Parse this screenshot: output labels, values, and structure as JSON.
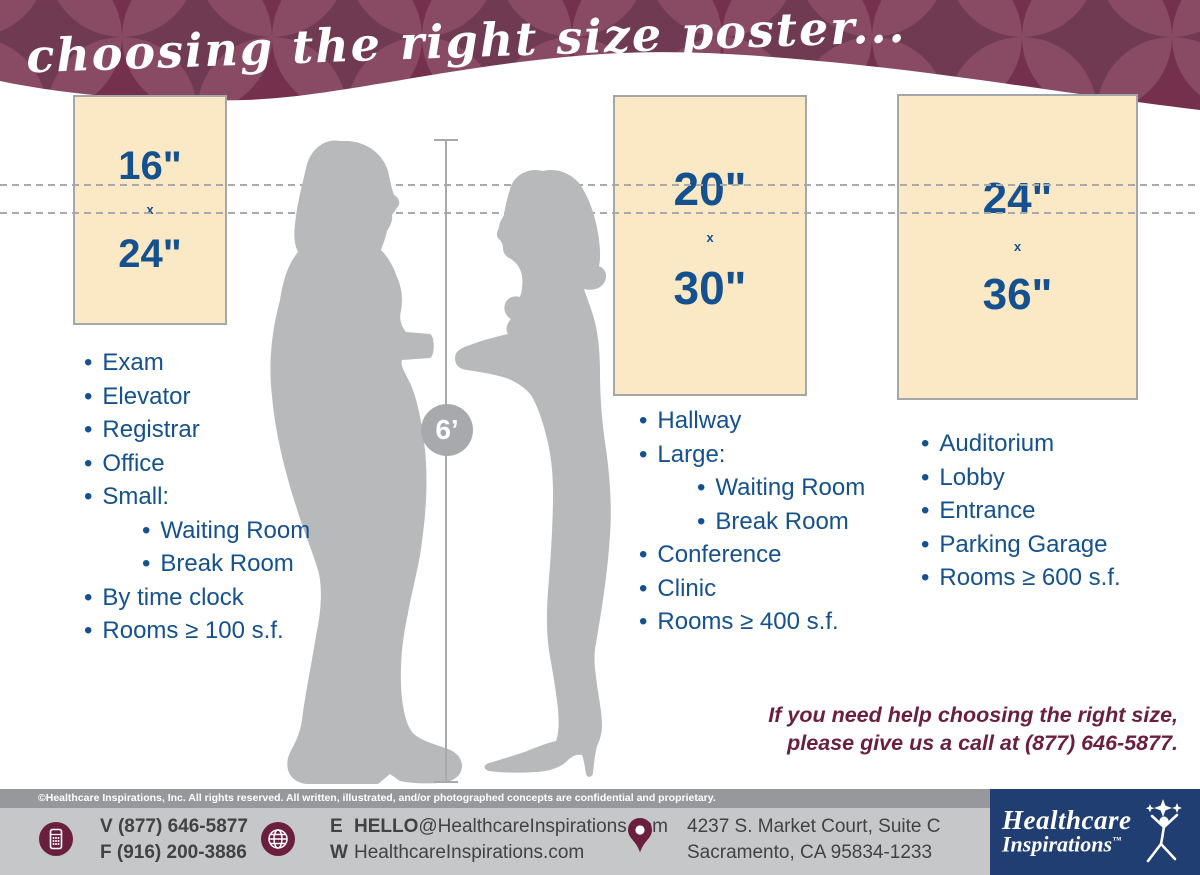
{
  "colors": {
    "maroon": "#6b1f3e",
    "navy": "#203e72",
    "blue": "#14518e",
    "cream": "#fbe8c4",
    "creamBorder": "#a3a7ab",
    "silhouette": "#b7b9bb",
    "grayLine": "#a7a9ac",
    "dashGray": "#a8aaac",
    "stripGray": "#97989b",
    "barGray": "#c6c7c9",
    "textDark": "#414244",
    "patternDark": "#3c0e29",
    "patternMid": "#74304c",
    "patternLight": "#9b5e76"
  },
  "header": {
    "title": "choosing the right size poster..."
  },
  "ui": {
    "bullet": "•"
  },
  "measure": {
    "label": "6’"
  },
  "posters": [
    {
      "size_top": "16\"",
      "size_mid": "x",
      "size_bottom": "24\"",
      "locations": [
        {
          "text": "Exam"
        },
        {
          "text": "Elevator"
        },
        {
          "text": "Registrar"
        },
        {
          "text": "Office"
        },
        {
          "text": "Small:"
        },
        {
          "text": "Waiting Room",
          "indent": true
        },
        {
          "text": "Break Room",
          "indent": true
        },
        {
          "text": "By time clock"
        },
        {
          "text": "Rooms ≥ 100 s.f."
        }
      ]
    },
    {
      "size_top": "20\"",
      "size_mid": "x",
      "size_bottom": "30\"",
      "locations": [
        {
          "text": "Hallway"
        },
        {
          "text": "Large:"
        },
        {
          "text": "Waiting Room",
          "indent": true
        },
        {
          "text": "Break Room",
          "indent": true
        },
        {
          "text": "Conference"
        },
        {
          "text": "Clinic"
        },
        {
          "text": "Rooms ≥ 400 s.f."
        }
      ]
    },
    {
      "size_top": "24\"",
      "size_mid": "x",
      "size_bottom": "36\"",
      "locations": [
        {
          "text": "Auditorium"
        },
        {
          "text": "Lobby"
        },
        {
          "text": "Entrance"
        },
        {
          "text": "Parking Garage"
        },
        {
          "text": "Rooms ≥ 600 s.f."
        }
      ]
    }
  ],
  "help": {
    "line1": "If you need help choosing the right size,",
    "line2": "please give us a call at (877) 646-5877."
  },
  "footer": {
    "copyright": "©Healthcare Inspirations, Inc.  All rights reserved. All written, illustrated, and/or photographed concepts are confidential and proprietary.",
    "phone": {
      "v_label": "V",
      "v_value": "(877) 646-5877",
      "f_label": "F",
      "f_value": "(916) 200-3886"
    },
    "web": {
      "e_label": "E",
      "e_bold": "HELLO",
      "e_rest": "@HealthcareInspirations.com",
      "w_label": "W",
      "w_value": "HealthcareInspirations.com"
    },
    "address": {
      "line1": "4237 S. Market Court, Suite C",
      "line2": "Sacramento, CA 95834-1233"
    },
    "logo": {
      "line1": "Healthcare",
      "line2": "Inspirations",
      "tm": "™"
    }
  }
}
